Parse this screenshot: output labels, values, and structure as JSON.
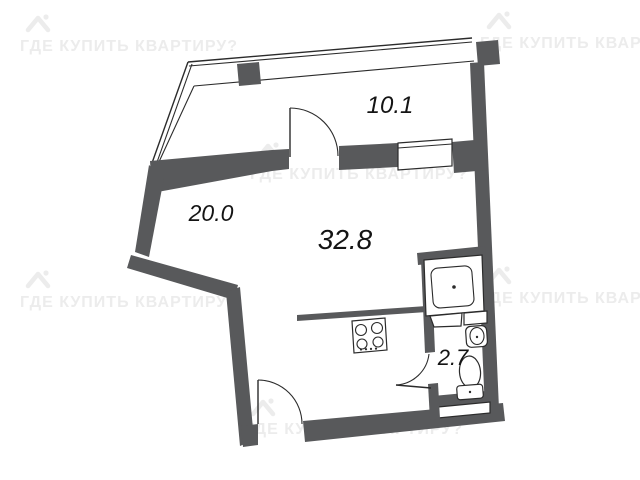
{
  "watermark": {
    "text": "ГДЕ КУПИТЬ КВАРТИРУ?",
    "color": "#ececec"
  },
  "rooms": [
    {
      "name": "hallway-top",
      "area": "10.1"
    },
    {
      "name": "room-left",
      "area": "20.0"
    },
    {
      "name": "main-room",
      "area": "32.8"
    },
    {
      "name": "bathroom",
      "area": "2.7"
    }
  ],
  "colors": {
    "wall": "#58595b",
    "line": "#2b2b2b",
    "background": "#ffffff",
    "label": "#141414",
    "watermark": "#ececec"
  }
}
